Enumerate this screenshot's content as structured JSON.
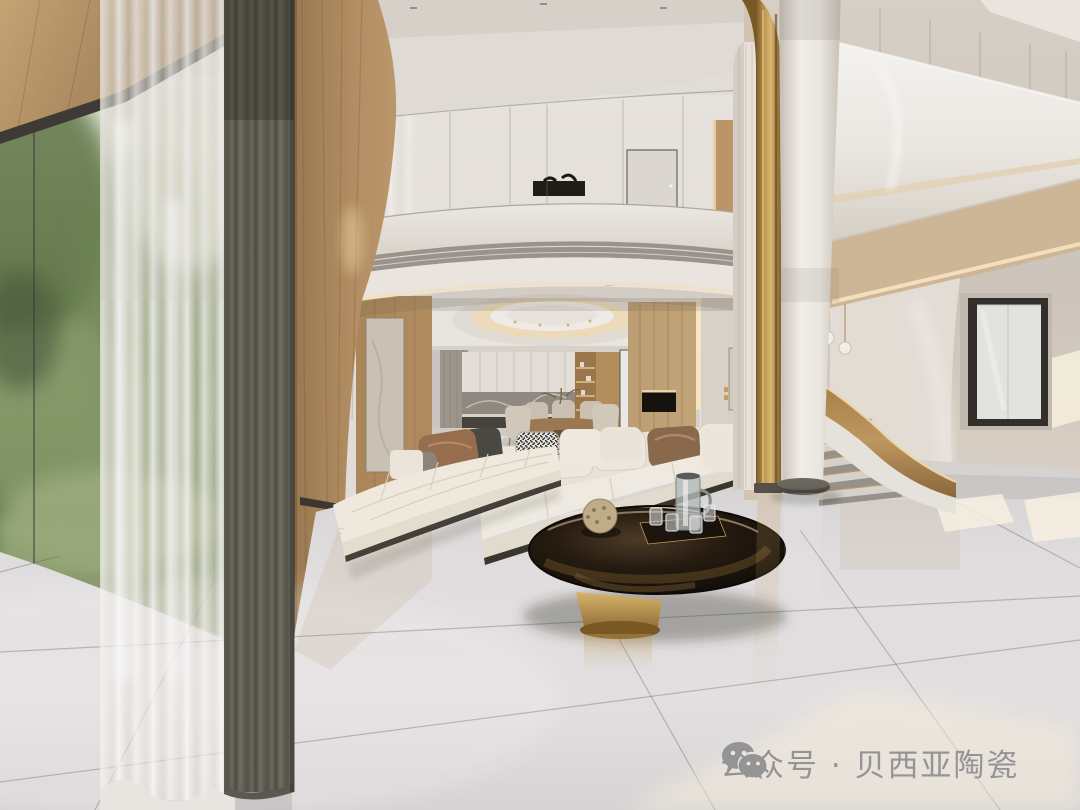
{
  "watermark": {
    "icon": "wechat-icon",
    "text": "公众号 · 贝西亚陶瓷",
    "color": "#8e8e90"
  },
  "palette": {
    "floor_tile": "#e6e4e5",
    "wood_panel": "#b68f60",
    "gold_accent": "#b98f4d",
    "dark_curtain": "#66655b",
    "sheer_curtain": "#f4f2ee",
    "sofa_cream": "#f2ede2",
    "right_wall": "#d6cfc5",
    "greenery": "#7d9163",
    "table_glass": "#241b13",
    "watermark_grey": "#8e8e90"
  },
  "scene": {
    "elements": [
      "floor-to-ceiling-window",
      "sheer-curtain",
      "blackout-curtain",
      "wood-feature-wall",
      "art-panel",
      "mezzanine-balcony",
      "glass-railing",
      "ac-grille",
      "balcony-door",
      "ceiling-dome",
      "kitchen-cabinets",
      "dining-set",
      "sectional-sofa",
      "chaise-lounge",
      "coffee-table",
      "white-column",
      "gold-column",
      "curved-staircase",
      "pendant-lights",
      "side-window",
      "marble-tile-floor"
    ]
  }
}
